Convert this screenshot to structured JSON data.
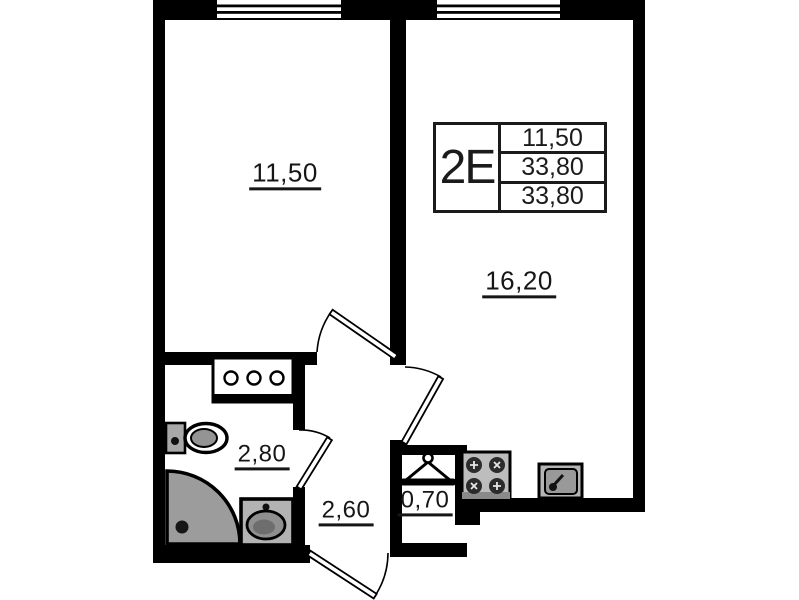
{
  "info_box": {
    "unit_type": "2Е",
    "area_rows": [
      "11,50",
      "33,80",
      "33,80"
    ]
  },
  "room_labels": {
    "room_1": "11,50",
    "kitchen_living": "16,20",
    "bathroom": "2,80",
    "hall": "2,60",
    "closet": "0,70"
  },
  "colors": {
    "wall": "#000000",
    "fixture_gray": "#9c9c9c",
    "background": "#ffffff"
  },
  "icons": {
    "window": "window-symbol",
    "door": "door-swing",
    "hanger": "coat-hanger",
    "toilet": "toilet",
    "shower": "corner-shower-tray",
    "washbasin": "washbasin",
    "stove": "stove-four-burners",
    "sink": "kitchen-sink"
  }
}
